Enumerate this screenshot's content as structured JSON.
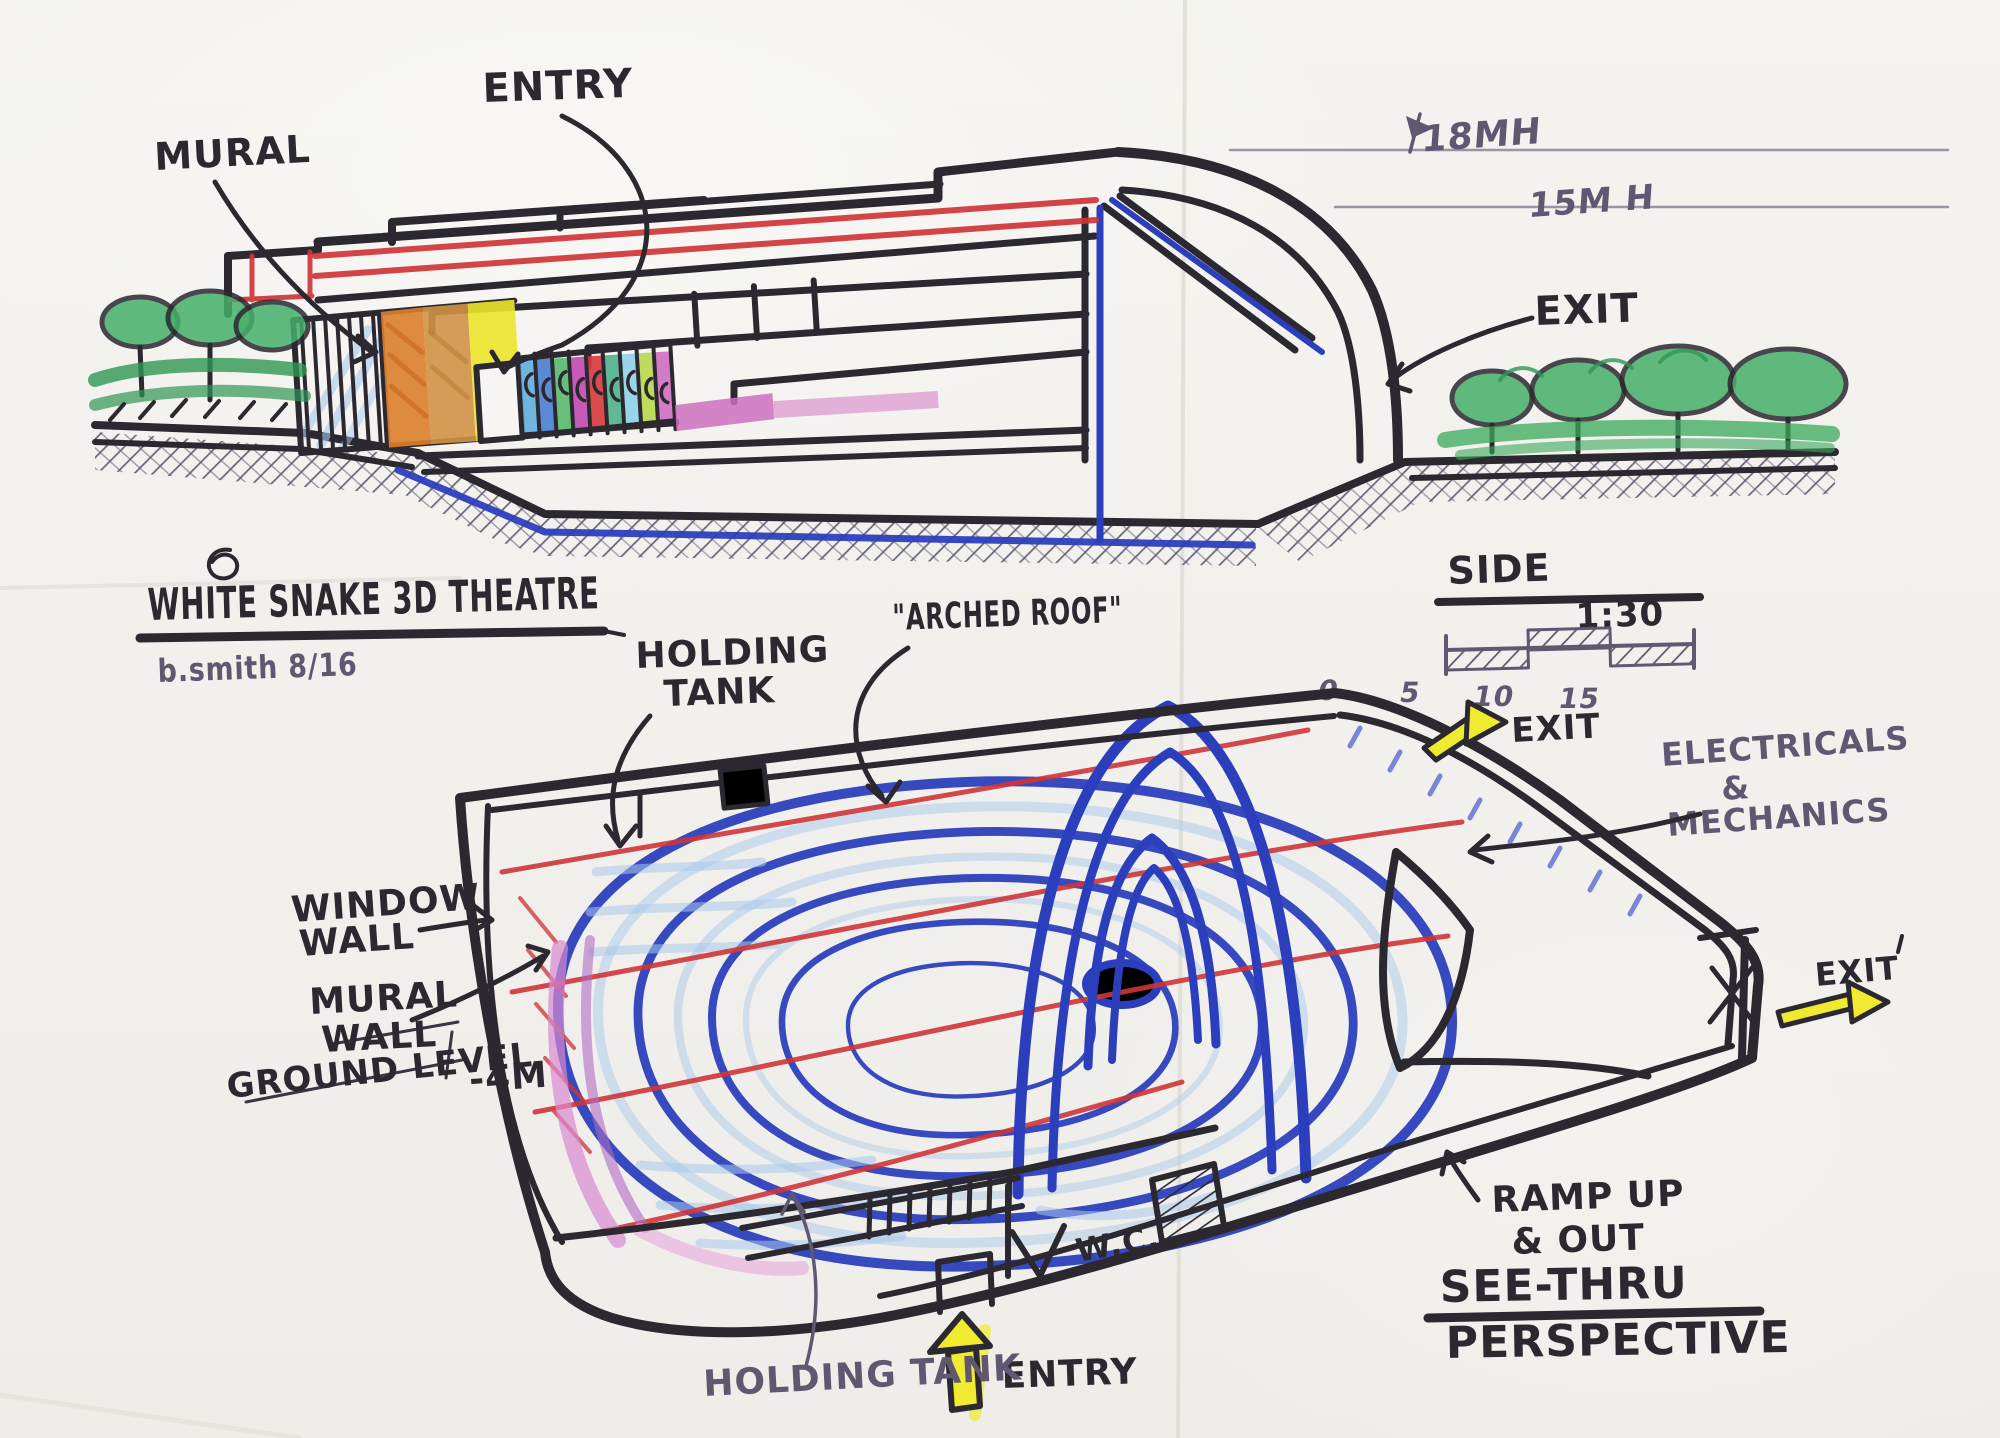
{
  "title_block": {
    "title": "WHITE SNAKE 3D THEATRE",
    "signature": "b.smith 8/16"
  },
  "elevation": {
    "labels": {
      "mural": "MURAL",
      "entry": "ENTRY",
      "exit": "EXIT"
    },
    "heights": {
      "h18": "18MH",
      "h15": "15M H"
    },
    "view": {
      "name": "SIDE",
      "scale_ratio": "1:30",
      "ticks": [
        "0",
        "5",
        "10",
        "15"
      ]
    }
  },
  "perspective": {
    "labels": {
      "holding_tank_top_1": "HOLDING",
      "holding_tank_top_2": "TANK",
      "arched_roof": "\"ARCHED ROOF\"",
      "exit_top": "EXIT",
      "electricals_1": "ELECTRICALS",
      "electricals_2": "&",
      "electricals_3": "MECHANICS",
      "window_wall_1": "WINDOW",
      "window_wall_2": "WALL",
      "mural_wall_1": "MURAL",
      "mural_wall_2": "WALL",
      "ground_level": "GROUND LEVEL",
      "ground_level_value": "-4M",
      "wc": "W.C.",
      "exit_right": "EXIT",
      "ramp_1": "RAMP UP",
      "ramp_2": "& OUT",
      "entry": "ENTRY",
      "holding_tank_bottom": "HOLDING TANK",
      "view_name_1": "SEE-THRU",
      "view_name_2": "PERSPECTIVE"
    }
  },
  "colors": {
    "ink": "#2b2830",
    "pen": "#5f5870",
    "marker_blue": "#2b3fbd",
    "pencil_light_blue": "#a8c9ec",
    "pencil_red": "#cf3538",
    "highlight_yellow": "#f0ea30",
    "crayon_green": "#46b06a",
    "crayon_orange": "#dd7f2b",
    "crayon_tan": "#d19246",
    "crayon_yellow": "#ece42b",
    "crayon_pink": "#cf6ec0",
    "mural_panels": [
      "#62aede",
      "#4b7fd2",
      "#58b96e",
      "#c04ab0",
      "#d8393b",
      "#4fb389",
      "#8fd0e8",
      "#b8d84e",
      "#cf6ec0"
    ]
  }
}
